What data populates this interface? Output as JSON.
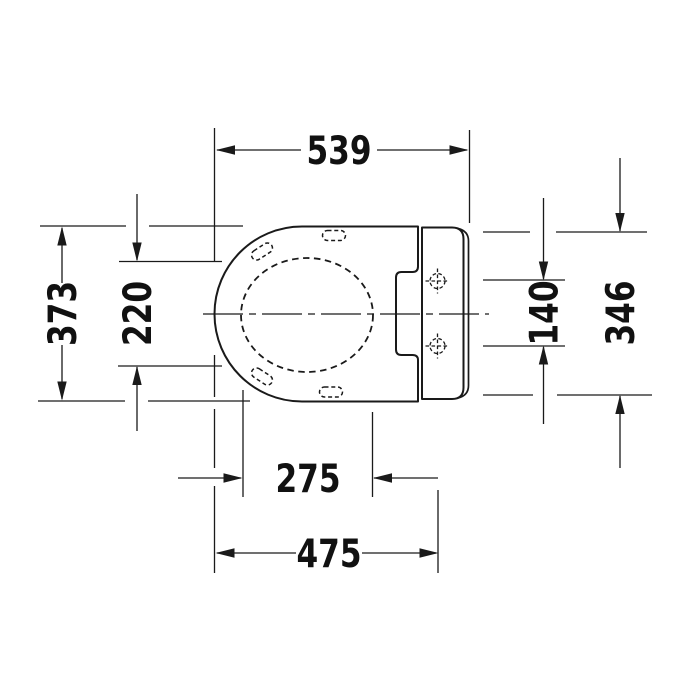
{
  "drawing": {
    "colors": {
      "line": "#1a1a1a",
      "background": "#ffffff"
    },
    "dimensions": {
      "overall_width": "539",
      "overall_depth": "373",
      "seat_opening_depth": "220",
      "hinge_hole_spacing": "140",
      "unit_depth": "346",
      "opening_width": "275",
      "front_to_hinge_axis": "475"
    }
  }
}
